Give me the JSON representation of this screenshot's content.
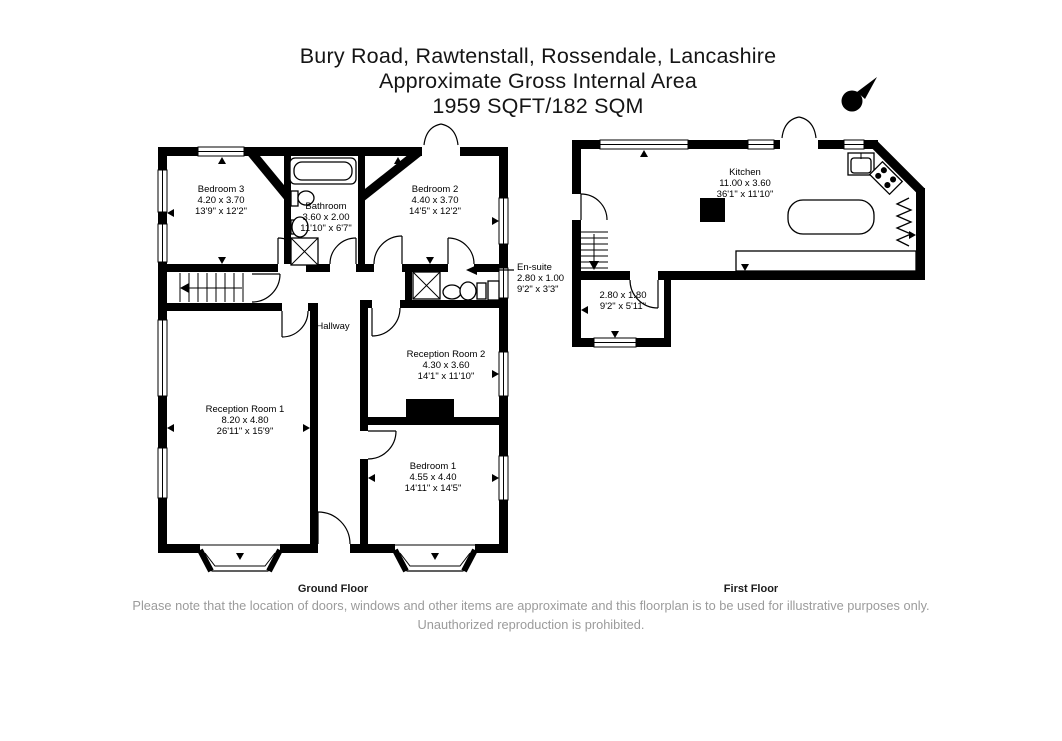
{
  "title": {
    "line1": "Bury Road, Rawtenstall, Rossendale, Lancashire",
    "line2": "Approximate Gross Internal Area",
    "line3": "1959 SQFT/182 SQM"
  },
  "compass": {
    "letter": "N"
  },
  "ground_floor": {
    "label": "Ground Floor",
    "rooms": [
      {
        "name": "Bedroom 3",
        "metric": "4.20 x 3.70",
        "imperial": "13'9\" x 12'2\""
      },
      {
        "name": "Bathroom",
        "metric": "3.60 x 2.00",
        "imperial": "11'10\" x 6'7\""
      },
      {
        "name": "Bedroom 2",
        "metric": "4.40 x 3.70",
        "imperial": "14'5\" x 12'2\""
      },
      {
        "name": "En-suite",
        "metric": "2.80 x 1.00",
        "imperial": "9'2\" x 3'3\""
      },
      {
        "name": "Hallway",
        "metric": "",
        "imperial": ""
      },
      {
        "name": "Reception Room 2",
        "metric": "4.30 x 3.60",
        "imperial": "14'1\" x 11'10\""
      },
      {
        "name": "Reception Room 1",
        "metric": "8.20 x 4.80",
        "imperial": "26'11\" x 15'9\""
      },
      {
        "name": "Bedroom 1",
        "metric": "4.55 x 4.40",
        "imperial": "14'11\" x 14'5\""
      }
    ]
  },
  "first_floor": {
    "label": "First Floor",
    "rooms": [
      {
        "name": "Kitchen",
        "metric": "11.00 x 3.60",
        "imperial": "36'1\" x 11'10\""
      },
      {
        "name": "",
        "metric": "2.80 x 1.80",
        "imperial": "9'2\" x 5'11\""
      }
    ]
  },
  "disclaimer": "Please note that the location of doors, windows and other items are approximate and this floorplan is to be used for illustrative purposes only. Unauthorized reproduction is prohibited.",
  "colors": {
    "wall": "#000000",
    "background": "#ffffff",
    "disclaimer_text": "#9b9b9b"
  }
}
